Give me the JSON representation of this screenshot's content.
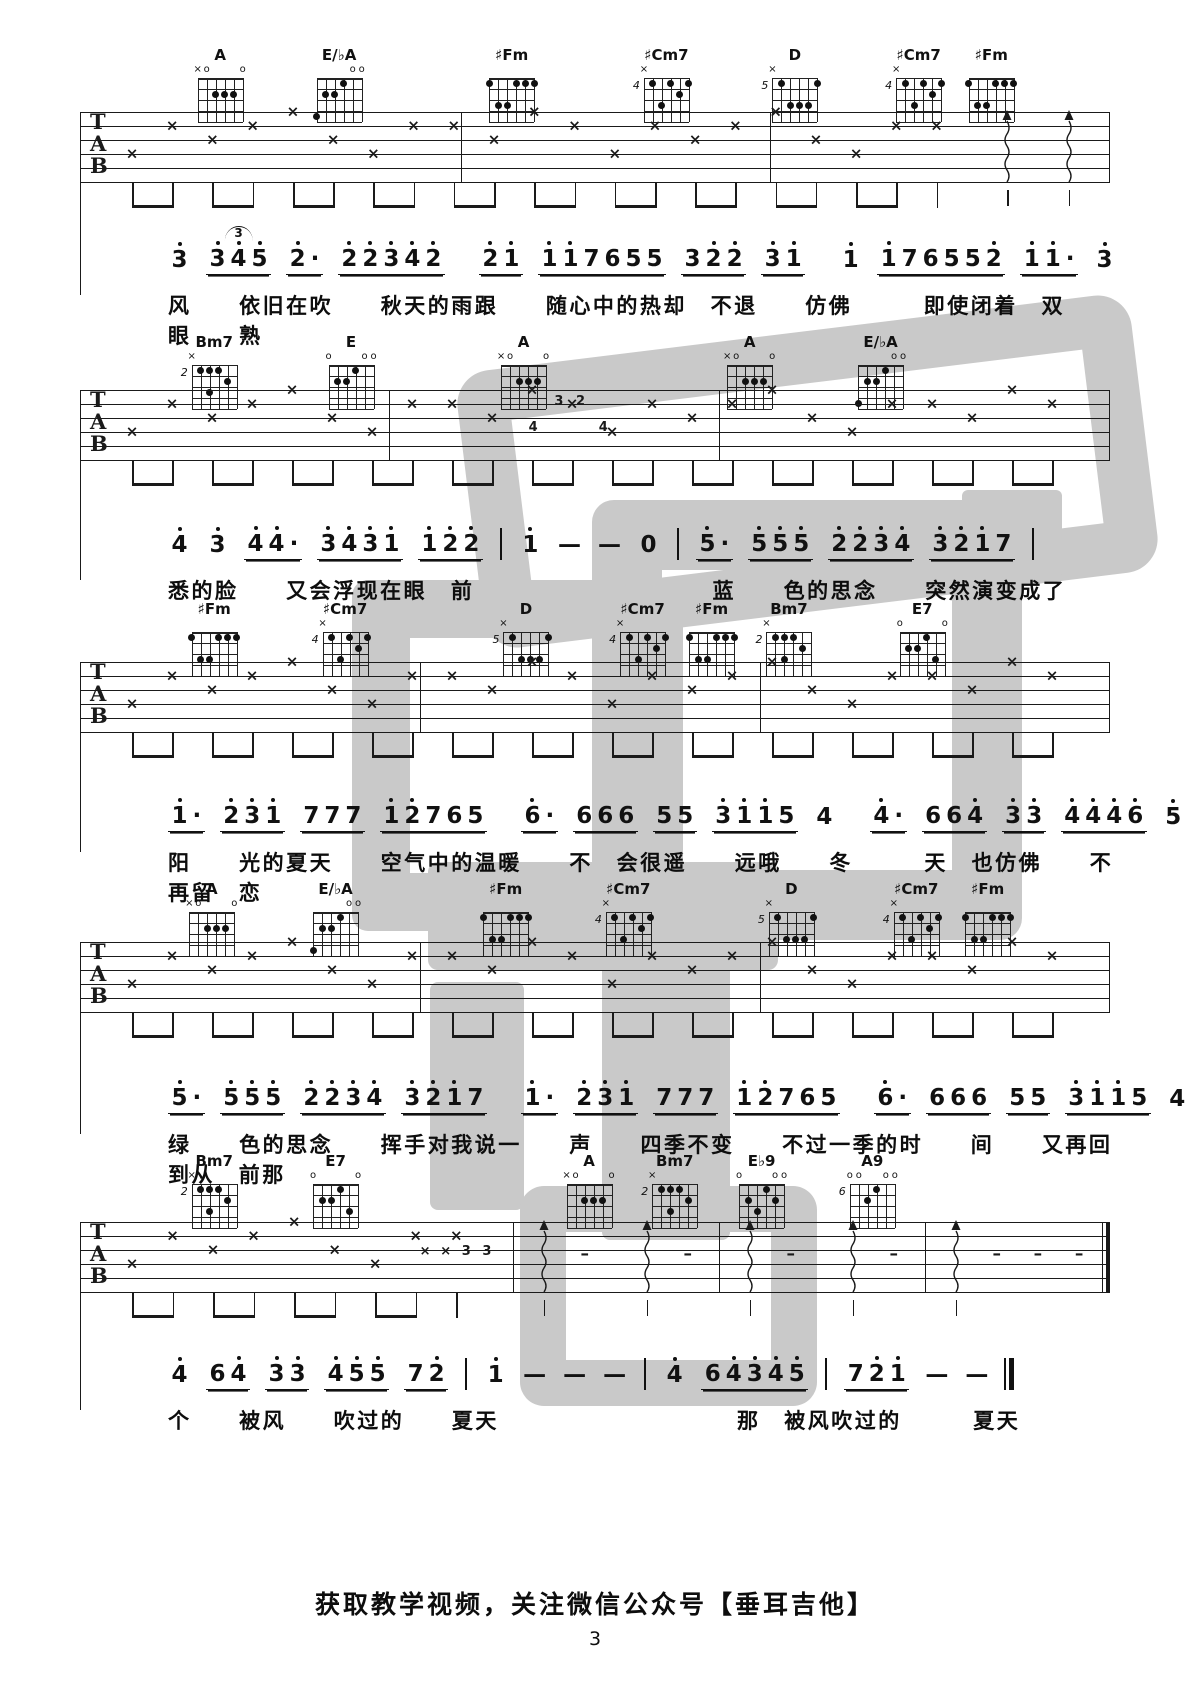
{
  "page": {
    "footer": "获取教学视频，关注微信公众号【垂耳吉他】",
    "page_number": "3",
    "ink_color": "#1a1a1a",
    "watermark": {
      "text": "垂耳吉他",
      "color": "#c9c9c9",
      "shapes": [
        {
          "x": 468,
          "y": 332,
          "w": 575,
          "h": 175,
          "type": "ring",
          "b": 52,
          "r": 34,
          "rot": -7
        },
        {
          "x": 962,
          "y": 490,
          "w": 100,
          "h": 88,
          "type": "fill",
          "r": 6,
          "rot": 0
        },
        {
          "x": 592,
          "y": 500,
          "w": 290,
          "h": 300,
          "type": "ring",
          "b": 70,
          "r": 22,
          "rot": 0
        },
        {
          "x": 352,
          "y": 580,
          "w": 215,
          "h": 235,
          "type": "ring",
          "b": 58,
          "r": 16,
          "rot": 0
        },
        {
          "x": 428,
          "y": 862,
          "w": 350,
          "h": 108,
          "type": "fill",
          "r": 10,
          "rot": 0
        },
        {
          "x": 602,
          "y": 962,
          "w": 128,
          "h": 278,
          "type": "fill",
          "r": 8,
          "rot": 0
        },
        {
          "x": 430,
          "y": 982,
          "w": 94,
          "h": 228,
          "type": "fill",
          "r": 8,
          "rot": 0
        },
        {
          "x": 520,
          "y": 1186,
          "w": 205,
          "h": 128,
          "type": "ring",
          "b": 46,
          "r": 24,
          "rot": 0
        }
      ]
    }
  },
  "tab_letters": [
    "T",
    "A",
    "B"
  ],
  "chord_shapes": {
    "A": {
      "name": "A",
      "base": "",
      "top": [
        "x",
        "o",
        "",
        "",
        "",
        "o"
      ],
      "dots": [
        [
          3,
          2
        ],
        [
          4,
          2
        ],
        [
          5,
          2
        ]
      ]
    },
    "EbA": {
      "name": "E/♭A",
      "base": "",
      "top": [
        "",
        "",
        "",
        "",
        "o",
        "o"
      ],
      "dots": [
        [
          4,
          1
        ],
        [
          2,
          2
        ],
        [
          3,
          2
        ],
        [
          1,
          4
        ]
      ]
    },
    "sFm": {
      "name": "♯Fm",
      "base": "",
      "top": [
        "",
        "",
        "",
        "",
        "",
        ""
      ],
      "dots": [
        [
          1,
          1
        ],
        [
          4,
          1
        ],
        [
          5,
          1
        ],
        [
          6,
          1
        ],
        [
          2,
          3
        ],
        [
          3,
          3
        ]
      ]
    },
    "sCm7": {
      "name": "♯Cm7",
      "base": "4",
      "top": [
        "x",
        "",
        "",
        "",
        "",
        ""
      ],
      "dots": [
        [
          2,
          1
        ],
        [
          4,
          1
        ],
        [
          6,
          1
        ],
        [
          5,
          2
        ],
        [
          3,
          3
        ]
      ]
    },
    "D5": {
      "name": "D",
      "base": "5",
      "top": [
        "x",
        "",
        "",
        "",
        "",
        ""
      ],
      "dots": [
        [
          2,
          1
        ],
        [
          6,
          1
        ],
        [
          3,
          3
        ],
        [
          4,
          3
        ],
        [
          5,
          3
        ]
      ]
    },
    "Bm7": {
      "name": "Bm7",
      "base": "2",
      "top": [
        "x",
        "",
        "",
        "",
        "",
        ""
      ],
      "dots": [
        [
          2,
          1
        ],
        [
          3,
          1
        ],
        [
          4,
          1
        ],
        [
          5,
          2
        ],
        [
          3,
          3
        ]
      ]
    },
    "E": {
      "name": "E",
      "base": "",
      "top": [
        "o",
        "",
        "",
        "",
        "o",
        "o"
      ],
      "dots": [
        [
          4,
          1
        ],
        [
          2,
          2
        ],
        [
          3,
          2
        ]
      ]
    },
    "E7": {
      "name": "E7",
      "base": "",
      "top": [
        "o",
        "",
        "",
        "",
        "",
        "o"
      ],
      "dots": [
        [
          4,
          1
        ],
        [
          2,
          2
        ],
        [
          3,
          2
        ],
        [
          5,
          3
        ]
      ]
    },
    "Eb9": {
      "name": "E♭9",
      "base": "",
      "top": [
        "o",
        "",
        "",
        "",
        "o",
        "o"
      ],
      "dots": [
        [
          4,
          1
        ],
        [
          2,
          2
        ],
        [
          5,
          2
        ],
        [
          3,
          3
        ]
      ]
    },
    "A9": {
      "name": "A9",
      "base": "6",
      "top": [
        "o",
        "o",
        "",
        "",
        "o",
        "o"
      ],
      "dots": [
        [
          4,
          1
        ],
        [
          3,
          2
        ]
      ]
    }
  },
  "systems": [
    {
      "layout": {
        "chord_top": 46,
        "staff_top": 112,
        "melody_top": 243,
        "lyric_top": 290
      },
      "chords": [
        {
          "shape": "A",
          "x": 18.5
        },
        {
          "shape": "EbA",
          "x": 28.5
        },
        {
          "shape": "sFm",
          "x": 43.0
        },
        {
          "shape": "sCm7",
          "x": 56.0
        },
        {
          "shape": "D5",
          "x": 66.8
        },
        {
          "shape": "sCm7",
          "x": 77.2
        },
        {
          "shape": "sFm",
          "x": 83.3
        }
      ],
      "staff": {
        "barlines": [
          37,
          67
        ],
        "notes_until": 88,
        "arrows": [
          90,
          96
        ],
        "dashes": [],
        "annotations": [],
        "end": "single"
      },
      "melody": [
        "3'",
        {
          "t": "3'4'5'",
          "tup": "3"
        },
        "2'·",
        "2'2'3'4'2'",
        "|",
        "2'1'",
        "1'1'7655",
        "32'2'",
        "3'1'",
        "|",
        "1'",
        "1'76552'",
        "1'1'·",
        "3'",
        "|"
      ],
      "lyrics": "风  依旧在吹  秋天的雨跟  随心中的热却 不退  仿佛   即使闭着 双  眼  熟"
    },
    {
      "layout": {
        "chord_top": 333,
        "staff_top": 390,
        "melody_top": 528,
        "lyric_top": 575
      },
      "chords": [
        {
          "shape": "Bm7",
          "x": 18.0
        },
        {
          "shape": "E",
          "x": 29.5
        },
        {
          "shape": "A",
          "x": 44.0
        },
        {
          "shape": "A",
          "x": 63.0
        },
        {
          "shape": "EbA",
          "x": 74.0
        }
      ],
      "staff": {
        "barlines": [
          30,
          62
        ],
        "notes_until": 100,
        "arrows": [],
        "dashes": [],
        "annotations": [
          {
            "t": "4",
            "x": 44.0,
            "y": 30
          },
          {
            "t": "3",
            "x": 46.5,
            "y": 4
          },
          {
            "t": "2",
            "x": 48.6,
            "y": 4
          },
          {
            "t": "4",
            "x": 50.8,
            "y": 30
          }
        ],
        "end": "single"
      },
      "melody": [
        "4'",
        "3'",
        "4'4'·",
        "3'4'3'1'",
        "1'2'2'",
        "|",
        "1'",
        "—",
        "—",
        "0",
        "|",
        "5'·",
        "5'5'5'",
        "2'2'3'4'",
        "3'2'1'7",
        "|"
      ],
      "lyrics": "悉的脸  又会浮现在眼 前          蓝  色的思念  突然演变成了"
    },
    {
      "layout": {
        "chord_top": 600,
        "staff_top": 662,
        "melody_top": 800,
        "lyric_top": 847
      },
      "chords": [
        {
          "shape": "sFm",
          "x": 18.0
        },
        {
          "shape": "sCm7",
          "x": 29.0
        },
        {
          "shape": "D5",
          "x": 44.2
        },
        {
          "shape": "sCm7",
          "x": 54.0
        },
        {
          "shape": "sFm",
          "x": 59.8
        },
        {
          "shape": "Bm7",
          "x": 66.3
        },
        {
          "shape": "E7",
          "x": 77.5
        }
      ],
      "staff": {
        "barlines": [
          33,
          66
        ],
        "notes_until": 100,
        "arrows": [],
        "dashes": [],
        "annotations": [],
        "end": "single"
      },
      "melody": [
        "1'·",
        "2'3'1'",
        "777",
        "1'2'765",
        "|",
        "6'·",
        "666",
        "55",
        "3'1'1'5",
        "4",
        "|",
        "4'·",
        "664'",
        "3'3'",
        "4'4'4'6'",
        "5'",
        "|"
      ],
      "lyrics": "阳  光的夏天  空气中的温暖  不 会很遥  远哦  冬   天 也仿佛  不再留 恋"
    },
    {
      "layout": {
        "chord_top": 880,
        "staff_top": 942,
        "melody_top": 1082,
        "lyric_top": 1129
      },
      "chords": [
        {
          "shape": "A",
          "x": 17.8
        },
        {
          "shape": "EbA",
          "x": 28.2
        },
        {
          "shape": "sFm",
          "x": 42.5
        },
        {
          "shape": "sCm7",
          "x": 52.8
        },
        {
          "shape": "D5",
          "x": 66.5
        },
        {
          "shape": "sCm7",
          "x": 77.0
        },
        {
          "shape": "sFm",
          "x": 83.0
        }
      ],
      "staff": {
        "barlines": [
          33,
          66
        ],
        "notes_until": 100,
        "arrows": [],
        "dashes": [],
        "annotations": [],
        "end": "single"
      },
      "melody": [
        "5'·",
        "5'5'5'",
        "2'2'3'4'",
        "3'2'1'7",
        "|",
        "1'·",
        "2'3'1'",
        "777",
        "1'2'765",
        "|",
        "6'·",
        "666",
        "55",
        "3'1'1'5",
        "4",
        "|"
      ],
      "lyrics": "绿  色的思念  挥手对我说一  声  四季不变  不过一季的时  间  又再回  到从 前那"
    },
    {
      "layout": {
        "chord_top": 1152,
        "staff_top": 1222,
        "melody_top": 1358,
        "lyric_top": 1405
      },
      "chords": [
        {
          "shape": "Bm7",
          "x": 18.0
        },
        {
          "shape": "E7",
          "x": 28.2
        },
        {
          "shape": "A",
          "x": 49.5
        },
        {
          "shape": "Bm7",
          "x": 56.7
        },
        {
          "shape": "Eb9",
          "x": 64.0
        },
        {
          "shape": "A9",
          "x": 73.3
        }
      ],
      "staff": {
        "barlines": [
          42,
          62,
          82
        ],
        "notes_until": 38,
        "arrows": [
          45,
          55,
          65,
          75,
          85
        ],
        "dashes": [
          49,
          59,
          69,
          79,
          89,
          93,
          97
        ],
        "annotations": [
          {
            "t": "×",
            "x": 33.5,
            "y": 22
          },
          {
            "t": "×",
            "x": 35.5,
            "y": 22
          },
          {
            "t": "3",
            "x": 37.5,
            "y": 22
          },
          {
            "t": "3",
            "x": 39.5,
            "y": 22
          }
        ],
        "end": "double"
      },
      "melody": [
        "4'",
        "64'",
        "3'3'",
        "4'5'5'",
        "72'",
        "|",
        "1'",
        "—",
        "—",
        "—",
        "|",
        "4'",
        "64'3'4'5'",
        "|",
        "72'1'",
        "—",
        "—",
        "‖"
      ],
      "lyrics": "个  被风  吹过的  夏天          那 被风吹过的   夏天"
    }
  ]
}
